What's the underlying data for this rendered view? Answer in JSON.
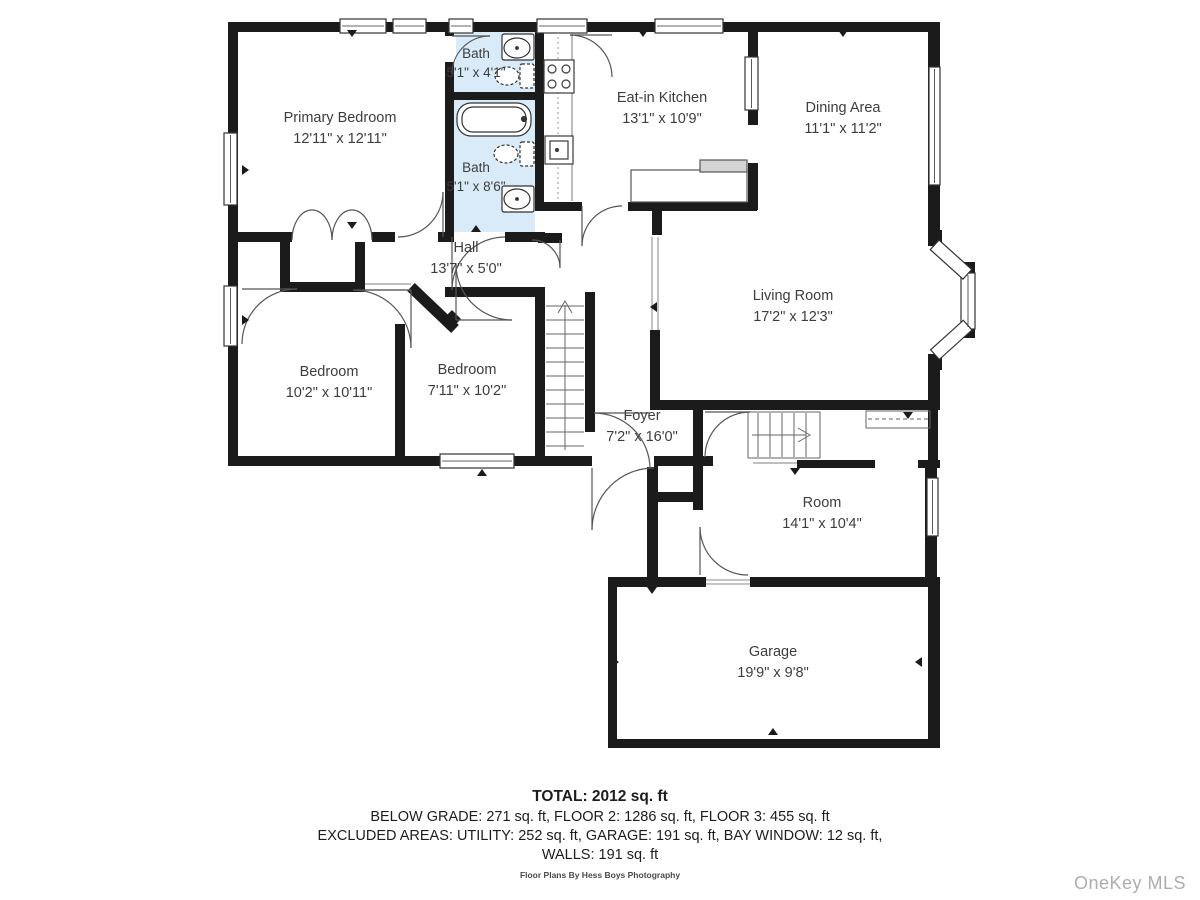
{
  "floor_plan": {
    "rooms": [
      {
        "name": "Primary Bedroom",
        "dims": "12'11\" x 12'11\""
      },
      {
        "name": "Bath",
        "dims": "5'1\" x 4'1\""
      },
      {
        "name": "Bath",
        "dims": "5'1\" x 8'6\""
      },
      {
        "name": "Eat-in Kitchen",
        "dims": "13'1\" x 10'9\""
      },
      {
        "name": "Dining Area",
        "dims": "11'1\" x 11'2\""
      },
      {
        "name": "Living Room",
        "dims": "17'2\" x 12'3\""
      },
      {
        "name": "Hall",
        "dims": "13'7\" x 5'0\""
      },
      {
        "name": "Bedroom",
        "dims": "10'2\" x 10'11\""
      },
      {
        "name": "Bedroom",
        "dims": "7'11\" x 10'2\""
      },
      {
        "name": "Foyer",
        "dims": "7'2\" x 16'0\""
      },
      {
        "name": "Room",
        "dims": "14'1\" x 10'4\""
      },
      {
        "name": "Garage",
        "dims": "19'9\" x 9'8\""
      }
    ],
    "summary": {
      "total": "TOTAL: 2012 sq. ft",
      "line2": "BELOW GRADE: 271 sq. ft, FLOOR 2: 1286 sq. ft, FLOOR 3: 455 sq. ft",
      "line3": "EXCLUDED AREAS: UTILITY: 252 sq. ft, GARAGE: 191 sq. ft, BAY WINDOW: 12 sq. ft,",
      "line4": "WALLS: 191 sq. ft"
    },
    "credit": "Floor Plans By Hess Boys Photography",
    "watermark": "OneKey MLS",
    "colors": {
      "wall": "#1b1b1b",
      "bath_fill": "#d9ebf8",
      "label_text": "#3d3d3d",
      "watermark_text": "#adadad"
    }
  }
}
